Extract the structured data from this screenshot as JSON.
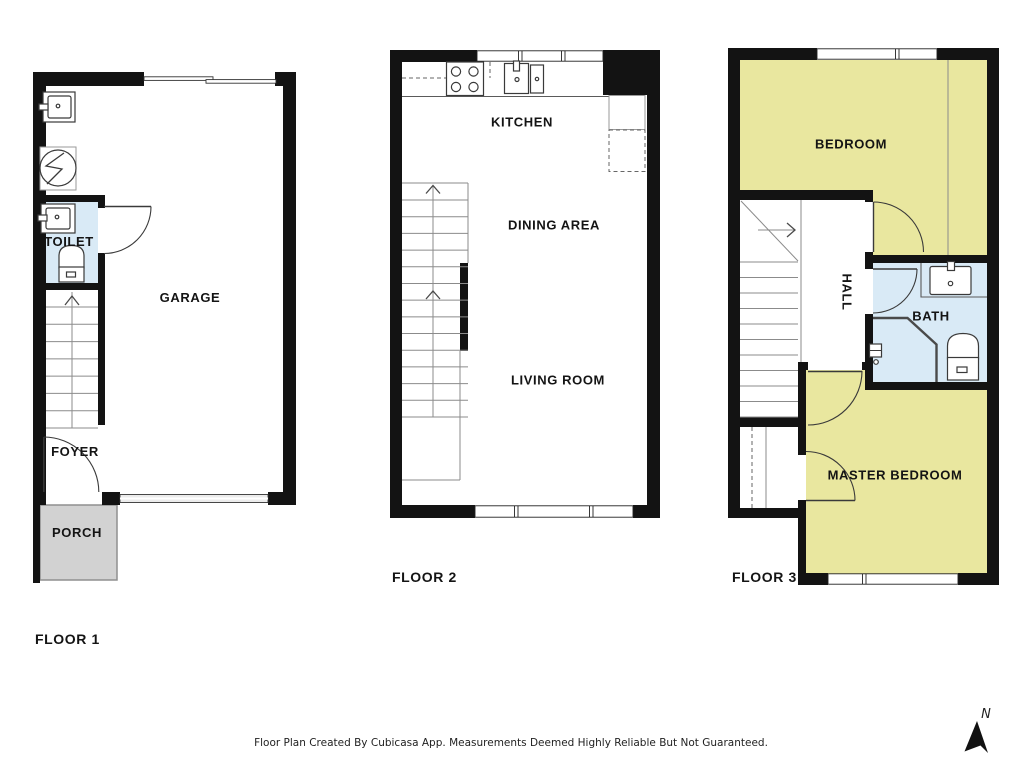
{
  "palette": {
    "wall": "#131313",
    "wet_room": "#d9eaf6",
    "bedroom": "#e9e79f",
    "porch": "#d2d2d2"
  },
  "floor1": {
    "label": "FLOOR 1",
    "rooms": {
      "toilet": "TOILET",
      "garage": "GARAGE",
      "foyer": "FOYER",
      "porch": "PORCH"
    }
  },
  "floor2": {
    "label": "FLOOR 2",
    "rooms": {
      "kitchen": "KITCHEN",
      "dining": "DINING AREA",
      "living": "LIVING ROOM"
    }
  },
  "floor3": {
    "label": "FLOOR 3",
    "rooms": {
      "bedroom": "BEDROOM",
      "hall": "HALL",
      "bath": "BATH",
      "master_bedroom": "MASTER BEDROOM"
    }
  },
  "compass": {
    "north_label": "N"
  },
  "footer": {
    "disclaimer": "Floor Plan Created By Cubicasa App. Measurements Deemed Highly Reliable But Not Guaranteed."
  }
}
